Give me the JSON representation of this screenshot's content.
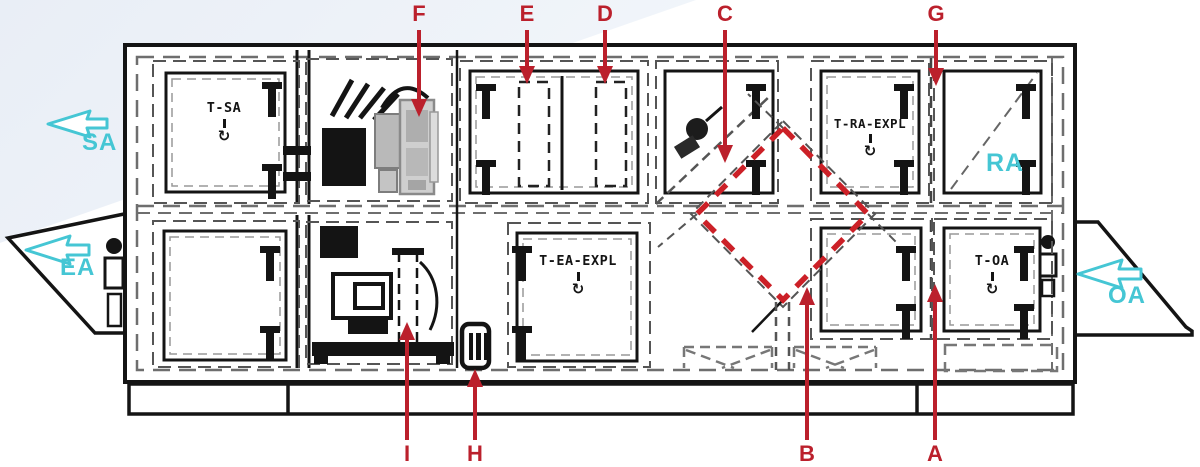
{
  "diagram": {
    "type": "air-handling-unit-plan-view",
    "colors": {
      "callout_red": "#bb202c",
      "highlight_red_dashed": "#cc2027",
      "flow_cyan": "#45c6d4",
      "line_black": "#141414",
      "dash_gray": "#6e6e6e"
    }
  },
  "airflow": {
    "sa": "SA",
    "ea": "EA",
    "ra": "RA",
    "oa": "OA"
  },
  "component_labels": {
    "t_sa": "T-SA",
    "t_ra_expl": "T-RA-EXPL",
    "t_ea_expl": "T-EA-EXPL",
    "t_oa": "T-OA"
  },
  "callouts": {
    "a": "A",
    "b": "B",
    "c": "C",
    "d": "D",
    "e": "E",
    "f": "F",
    "g": "G",
    "h": "H",
    "i": "I"
  },
  "icons": {
    "fan_rotation": "↻"
  }
}
